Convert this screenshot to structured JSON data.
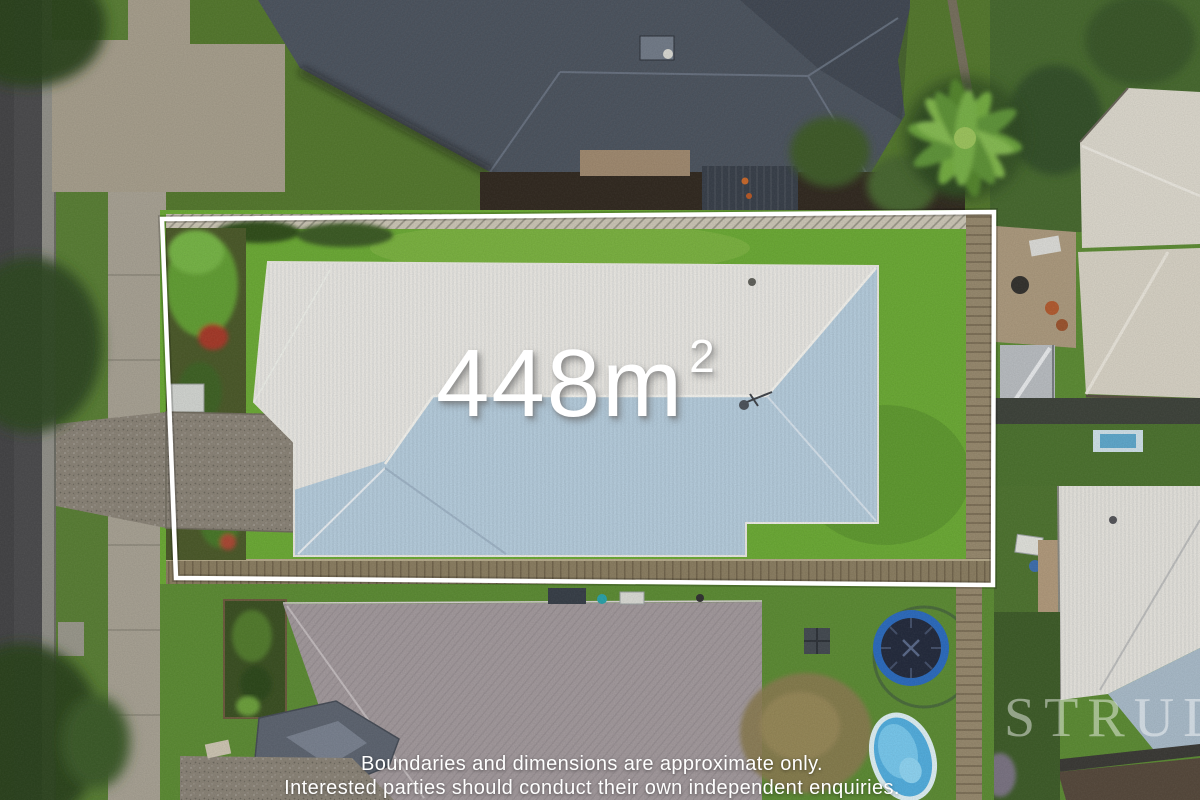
{
  "overlay": {
    "area_value": "448m",
    "area_exponent": "2",
    "disclaimer_line1": "Boundaries and dimensions are approximate only.",
    "disclaimer_line2": "Interested parties should conduct their own independent enquiries.",
    "watermark": "STRUD",
    "boundary_color": "#ffffff",
    "text_color": "#ffffff"
  },
  "scene": {
    "description": "aerial drone photo of suburban property with boundary outline",
    "colors": {
      "road": "#4c4c4e",
      "curb": "#92918a",
      "verge_grass": "#5a7f36",
      "sidewalk": "#a8a294",
      "driveway_concrete": "#a79f8d",
      "property_lawn": "#6caa36",
      "neighbor_lawn": "#4a6b30",
      "bottom_lawn": "#5d8c35",
      "roof_white": "#ebe9e4",
      "roof_shade_blue": "#b7cede",
      "dark_roof": "#4d5560",
      "bottom_roof": "#a39a9d",
      "bay_roof": "#5e6571",
      "beige_roof": "#d7d2c5",
      "white_roof_right": "#e6e4de",
      "fence_wood": "#8b7e62",
      "trampoline_rim": "#2d6cbe",
      "trampoline_mat": "#252c3e",
      "pool_water": "#53aede"
    }
  }
}
